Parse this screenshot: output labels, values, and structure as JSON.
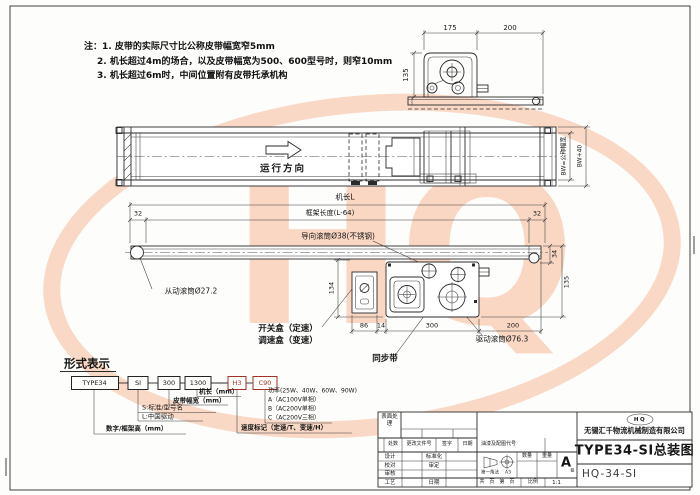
{
  "watermark": {
    "text": "HQ"
  },
  "notes": {
    "prefix": "注：",
    "line1": "1. 皮带的实际尺寸比公称皮带幅宽窄5mm",
    "line2": "2. 机长超过4m的场合，以及皮带幅宽为500、600型号时，则窄10mm",
    "line3": "3. 机长超过6m时，中间位置附有皮带托承机构"
  },
  "side_view": {
    "dim_motor": "175",
    "dim_rail": "200",
    "dim_height": "135"
  },
  "plan_view": {
    "direction": "运行方向",
    "belt_width": "BW=公称幅宽",
    "frame_width": "BW+40"
  },
  "front_view": {
    "machine_length": "机长L",
    "frame_length": "框架长度(L-64)",
    "end_offset_left": "32",
    "end_offset_right": "32",
    "guide_roller": "导向滚筒Ø38(不锈钢)",
    "driven_roller": "从动滚筒Ø27.2",
    "drive_roller": "驱动滚筒Ø76.3",
    "timing_belt": "同步带",
    "switch_box": "开关盒（定速）",
    "speed_box": "调速盒（变速）",
    "dim_height_box": "134",
    "dim_switch": "86",
    "dim_gap": "14",
    "dim_drive": "300",
    "dim_tail": "200",
    "dim_belt_h": "34",
    "dim_unit_h": "135"
  },
  "designation": {
    "title": "形式表示",
    "segments": [
      "TYPE34",
      "SI",
      "300",
      "1300",
      "H3",
      "C90"
    ],
    "labels": {
      "machine_length": "机长（mm）",
      "belt_width": "皮带幅宽（mm）",
      "standard": "S:标准/型号名",
      "china_drive": "L:中国驱动",
      "frame_height": "数字/框架高（mm）",
      "speed_mark": "速度标记（定速/T、变速/H）",
      "power": "功率(25W、40W、60W、90W)",
      "power_a": "A（AC100V单相）",
      "power_b": "B（AC200V单相）",
      "power_c": "C（AC200V三相）"
    }
  },
  "title_block": {
    "surface_treat": "表面处理",
    "col_counts": "处数",
    "col_change_doc": "更改文件号",
    "col_sign": "签字",
    "col_date": "日期",
    "paint_code": "油漆及配图代号",
    "design": "设计",
    "standardize": "标准化",
    "check": "校对",
    "approve": "审定",
    "review": "审核",
    "process": "工艺",
    "date": "日期",
    "projection": "第一角法",
    "sheet_size": "A3",
    "qty": "数量",
    "weight": "重量",
    "grade_letter": "A",
    "grade_sub": "级",
    "pages": "共　页　第　页",
    "scale_label": "比例",
    "scale_value": "1:1",
    "logo": "HQ",
    "company": "无锡汇千物流机械制造有限公司",
    "drawing_title": "TYPE34-SI总装图",
    "drawing_no": "HQ-34-SI"
  }
}
